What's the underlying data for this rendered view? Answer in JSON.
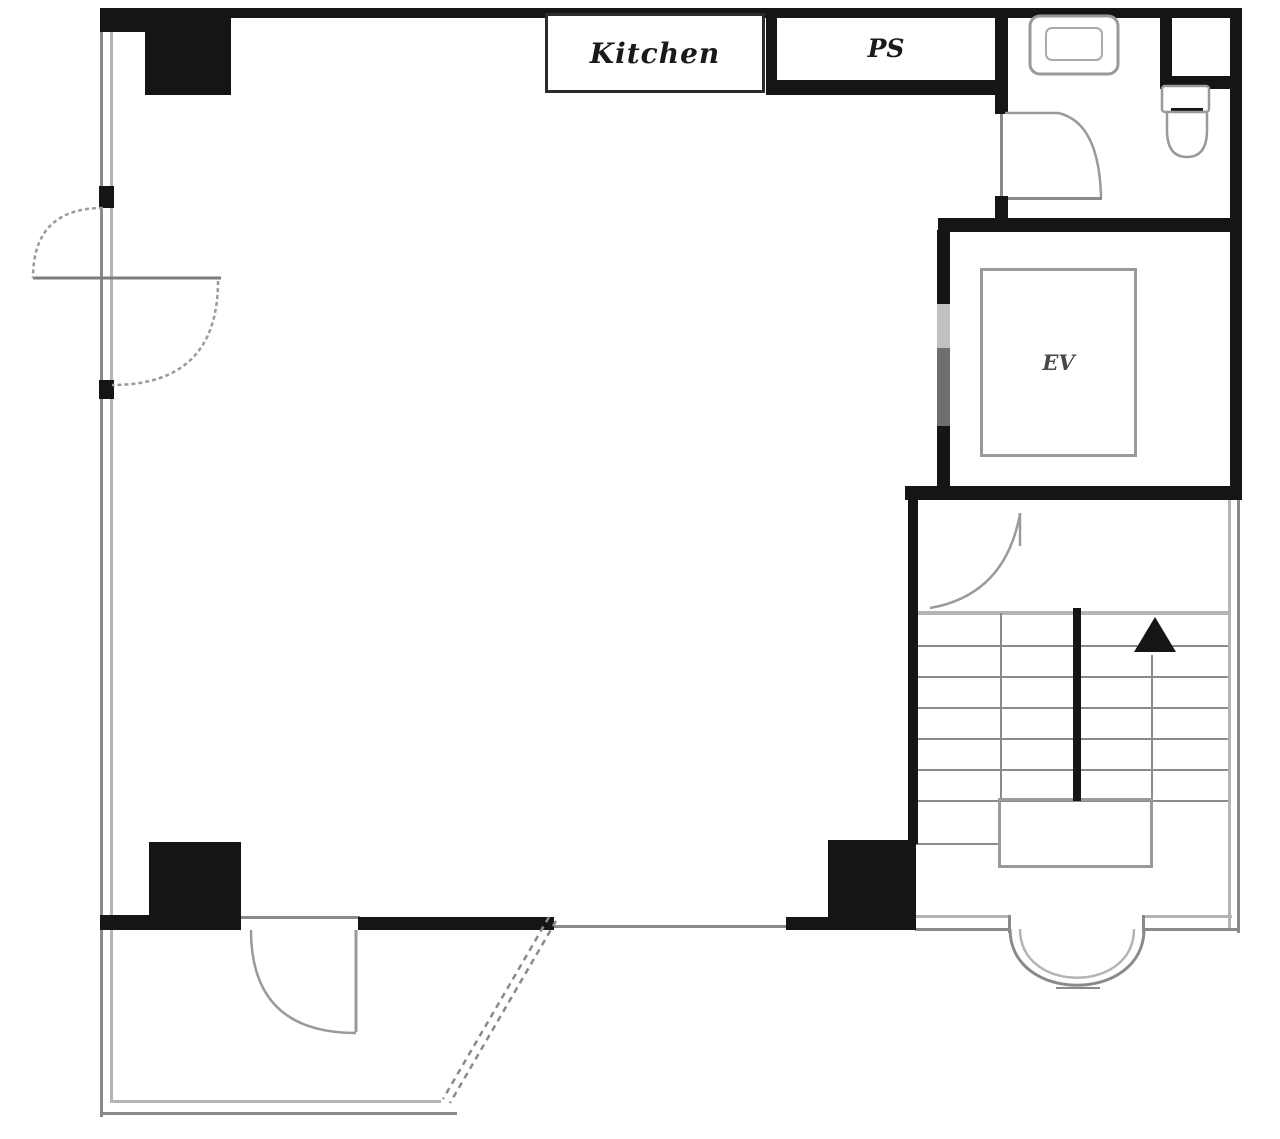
{
  "plan": {
    "kind": "floor-plan",
    "labels": {
      "kitchen": "Kitchen",
      "pipe_space": "PS",
      "elevator": "EV"
    },
    "features": {
      "stair_direction_marker": "up-arrow",
      "doors": [
        "main-left-double-door",
        "toilet-door",
        "stair-door",
        "entrance-door"
      ],
      "fixtures": [
        "sink",
        "toilet"
      ],
      "pillars": 3,
      "entrance_arch": "bottom-right curved opening",
      "porch": "bottom-left open terrace with diagonal dashed boundary"
    },
    "colors": {
      "background": "#ffffff",
      "wall": "#151515",
      "thin_line": "#8a8a8a",
      "light_line": "#b4b4b4",
      "door_arc": "#9a9a9a",
      "text": "#1a1a1a",
      "ev_text": "#474747",
      "ev_door_light": "#c0c0c0",
      "ev_door_dark": "#6e6e6e"
    },
    "icons": {
      "sink": "sink-icon",
      "toilet": "toilet-icon",
      "up_arrow": "stair-up-arrow-icon"
    }
  }
}
